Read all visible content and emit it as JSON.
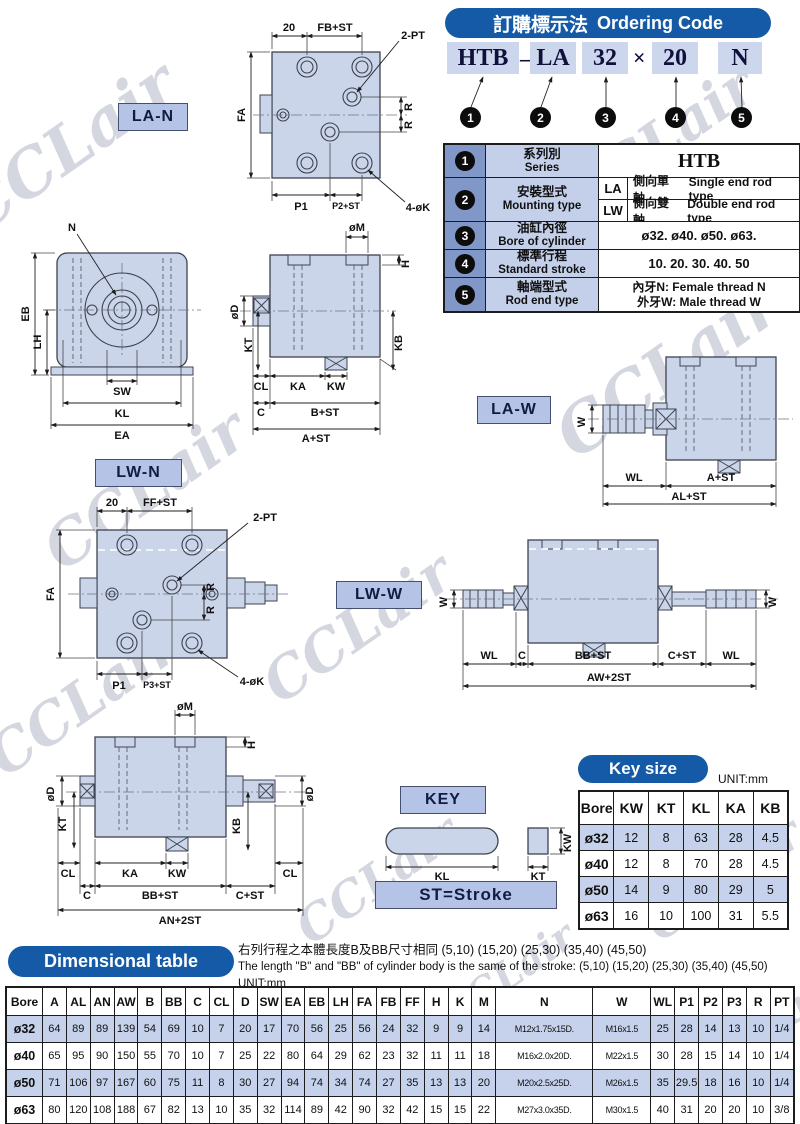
{
  "watermark": "CCLair",
  "ordering": {
    "title_zh": "訂購標示法",
    "title_en": "Ordering Code",
    "code": [
      "HTB",
      "–",
      "LA",
      "32",
      "×",
      "20",
      "N"
    ],
    "bullets": [
      "1",
      "2",
      "3",
      "4",
      "5"
    ]
  },
  "series": {
    "rows": [
      {
        "num": "1",
        "zh": "系列別",
        "en": "Series",
        "value": "HTB"
      },
      {
        "num": "2",
        "zh": "安裝型式",
        "en": "Mounting type",
        "sub": [
          {
            "code": "LA",
            "zh": "側向單軸",
            "en": "Single end rod type"
          },
          {
            "code": "LW",
            "zh": "側向雙軸",
            "en": "Double end rod type"
          }
        ]
      },
      {
        "num": "3",
        "zh": "油缸內徑",
        "en": "Bore of cylinder",
        "value": "ø32. ø40. ø50. ø63."
      },
      {
        "num": "4",
        "zh": "標準行程",
        "en": "Standard stroke",
        "value": "10. 20. 30. 40. 50"
      },
      {
        "num": "5",
        "zh": "軸端型式",
        "en": "Rod end type",
        "value_line1": "內牙N:  Female thread N",
        "value_line2": "外牙W:  Male thread W"
      }
    ]
  },
  "diagrams": {
    "la_n": {
      "label": "LA-N",
      "d": [
        "20",
        "FB+ST",
        "2-PT",
        "FA",
        "R",
        "R",
        "P1",
        "P2+ST",
        "4-øK"
      ]
    },
    "front": {
      "d": [
        "N",
        "EB",
        "LH",
        "SW",
        "KL",
        "EA"
      ]
    },
    "side": {
      "d": [
        "øM",
        "H",
        "øD",
        "KT",
        "CL",
        "KA",
        "KW",
        "KB",
        "C",
        "B+ST",
        "A+ST"
      ]
    },
    "la_w": {
      "label": "LA-W",
      "d": [
        "W",
        "WL",
        "A+ST",
        "AL+ST"
      ]
    },
    "lw_n": {
      "label": "LW-N",
      "d": [
        "20",
        "FF+ST",
        "2-PT",
        "FA",
        "R",
        "R",
        "P1",
        "P3+ST",
        "4-øK"
      ]
    },
    "lw_w": {
      "label": "LW-W",
      "d": [
        "W",
        "WL",
        "C",
        "BB+ST",
        "C+ST",
        "WL",
        "W",
        "AW+2ST"
      ]
    },
    "lw_side": {
      "d": [
        "øM",
        "H",
        "øD",
        "øD",
        "KT",
        "KB",
        "CL",
        "KA",
        "KW",
        "CL",
        "C",
        "BB+ST",
        "C+ST",
        "AN+2ST"
      ]
    },
    "key": {
      "label": "KEY",
      "d": [
        "KL",
        "KW",
        "KT"
      ],
      "stroke_note": "ST=Stroke"
    }
  },
  "key_size": {
    "title": "Key size",
    "unit": "UNIT:mm",
    "headers": [
      "Bore",
      "KW",
      "KT",
      "KL",
      "KA",
      "KB"
    ],
    "rows": [
      [
        "ø32",
        "12",
        "8",
        "63",
        "28",
        "4.5"
      ],
      [
        "ø40",
        "12",
        "8",
        "70",
        "28",
        "4.5"
      ],
      [
        "ø50",
        "14",
        "9",
        "80",
        "29",
        "5"
      ],
      [
        "ø63",
        "16",
        "10",
        "100",
        "31",
        "5.5"
      ]
    ]
  },
  "dimensional": {
    "title": "Dimensional table",
    "note_zh": "右列行程之本體長度B及BB尺寸相同 (5,10) (15,20) (25,30) (35,40)  (45,50)",
    "note_en": "The length \"B\" and \"BB\" of cylinder body is the same of the stroke: (5,10) (15,20) (25,30) (35,40) (45,50)   UNIT:mm",
    "headers": [
      "Bore",
      "A",
      "AL",
      "AN",
      "AW",
      "B",
      "BB",
      "C",
      "CL",
      "D",
      "SW",
      "EA",
      "EB",
      "LH",
      "FA",
      "FB",
      "FF",
      "H",
      "K",
      "M",
      "N",
      "W",
      "WL",
      "P1",
      "P2",
      "P3",
      "R",
      "PT"
    ],
    "rows": [
      [
        "ø32",
        "64",
        "89",
        "89",
        "139",
        "54",
        "69",
        "10",
        "7",
        "20",
        "17",
        "70",
        "56",
        "25",
        "56",
        "24",
        "32",
        "9",
        "9",
        "14",
        "M12x1.75x15D.",
        "M16x1.5",
        "25",
        "28",
        "14",
        "13",
        "10",
        "1/4"
      ],
      [
        "ø40",
        "65",
        "95",
        "90",
        "150",
        "55",
        "70",
        "10",
        "7",
        "25",
        "22",
        "80",
        "64",
        "29",
        "62",
        "23",
        "32",
        "11",
        "11",
        "18",
        "M16x2.0x20D.",
        "M22x1.5",
        "30",
        "28",
        "15",
        "14",
        "10",
        "1/4"
      ],
      [
        "ø50",
        "71",
        "106",
        "97",
        "167",
        "60",
        "75",
        "11",
        "8",
        "30",
        "27",
        "94",
        "74",
        "34",
        "74",
        "27",
        "35",
        "13",
        "13",
        "20",
        "M20x2.5x25D.",
        "M26x1.5",
        "35",
        "29.5",
        "18",
        "16",
        "10",
        "1/4"
      ],
      [
        "ø63",
        "80",
        "120",
        "108",
        "188",
        "67",
        "82",
        "13",
        "10",
        "35",
        "32",
        "114",
        "89",
        "42",
        "90",
        "32",
        "42",
        "15",
        "15",
        "22",
        "M27x3.0x35D.",
        "M30x1.5",
        "40",
        "31",
        "20",
        "20",
        "10",
        "3/8"
      ]
    ]
  }
}
